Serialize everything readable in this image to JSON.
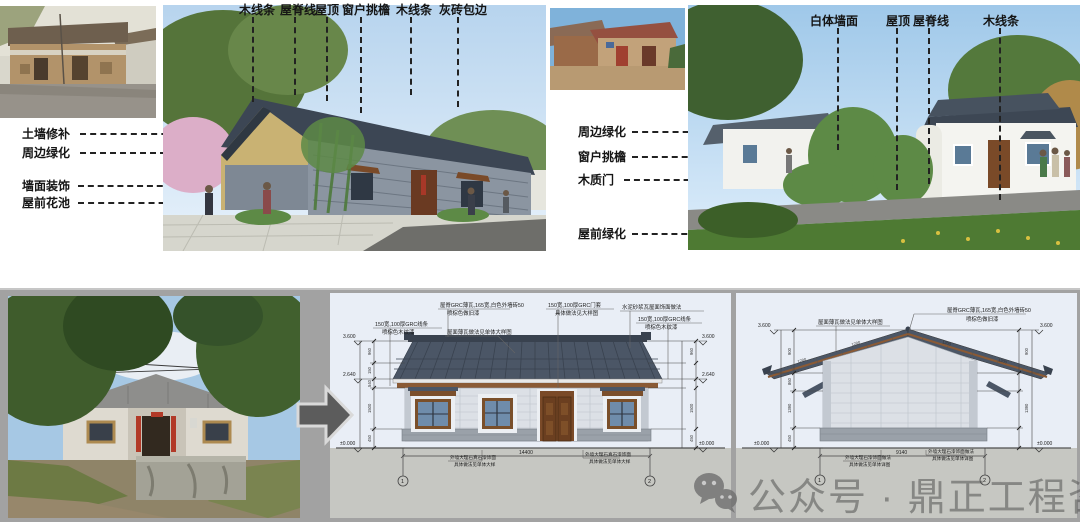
{
  "colors": {
    "panel_gray": "#a2a2a2",
    "drawing_bg": "#e9eef6",
    "drawing_ground": "#c6c7c2",
    "roof": "#4b5666",
    "wall": "#dce0e6",
    "base": "#9aa1a9",
    "door_wood": "#7a4a28",
    "watermark_gray": "#6e6e6e"
  },
  "top": {
    "photo1": "old-mud-wall-house-photo",
    "annot_col1": [
      "土墙修补",
      "周边绿化",
      "墙面装饰",
      "屋前花池"
    ],
    "render1_top_labels": [
      "木线条",
      "屋脊线",
      "屋顶",
      "窗户挑檐",
      "木线条",
      "灰砖包边"
    ],
    "photo2": "old-brick-house-photo",
    "annot_col2": [
      "周边绿化",
      "窗户挑檐",
      "木质门",
      "屋前绿化"
    ],
    "render2_top_labels": [
      "白体墙面",
      "屋顶",
      "屋脊线",
      "木线条"
    ]
  },
  "bottom": {
    "photo3": "old-white-house-photo",
    "front_elevation": {
      "callouts": [
        {
          "lines": [
            "150宽,100厚GRC线条",
            "喷棕色木纹漆"
          ]
        },
        {
          "lines": [
            "屋脊GRC薄瓦,165宽,白色外墙砖50",
            "喷棕色做旧漆"
          ]
        },
        {
          "lines": [
            "屋面薄瓦做法见单体大样图"
          ]
        },
        {
          "lines": [
            "150宽,100厚GRC门套",
            "具体做法见大样图"
          ]
        },
        {
          "lines": [
            "水泥砂浆瓦屋面饰面做法"
          ]
        },
        {
          "lines": [
            "150宽,100厚GRC线条",
            "喷棕色木纹漆"
          ]
        }
      ],
      "levels": [
        "3.600",
        "2.640",
        "±0.000"
      ],
      "seg_dims": [
        "960",
        "150",
        "540",
        "1500",
        "450"
      ],
      "overall_width": "14400",
      "axis_bubbles": [
        "1",
        "2"
      ],
      "notes": [
        [
          "外墙大理石真石漆饰面",
          "具体做法见单体大样"
        ],
        [
          "外墙大理石真石漆饰面",
          "具体做法见单体大样"
        ]
      ]
    },
    "side_elevation": {
      "callouts": [
        {
          "lines": [
            "屋面薄瓦做法见单体大样图"
          ]
        },
        {
          "lines": [
            "屋脊GRC薄瓦,165宽,白色外墙砖50",
            "喷棕色做旧漆"
          ]
        }
      ],
      "levels": [
        "3.600",
        "±0.000"
      ],
      "seg_dims": [
        "900",
        "860",
        "1390",
        "450"
      ],
      "slope_dim": "1200",
      "overall_width": "9140",
      "axis_bubbles": [
        "1",
        "2"
      ],
      "notes": [
        [
          "外墙大理石漆饰面做法",
          "具体做法见单体详图"
        ],
        [
          "外墙大理石漆饰面做法",
          "具体做法见单体详图"
        ]
      ]
    },
    "watermark": {
      "icon": "wechat-icon",
      "text": "公众号 · 鼎正工程咨询"
    }
  }
}
